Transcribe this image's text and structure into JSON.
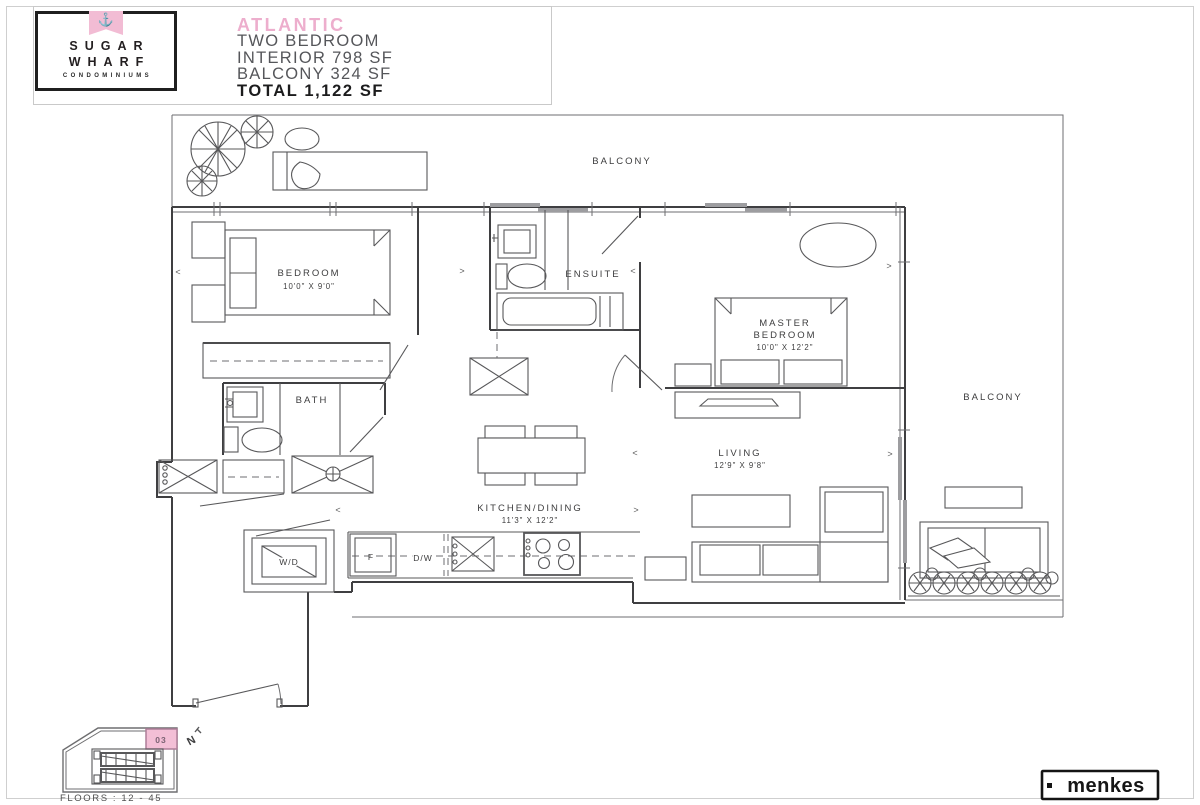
{
  "header": {
    "logo": {
      "anchor": "⚓",
      "word1": "SUGAR",
      "word2": "WHARF",
      "word3": "CONDOMINIUMS"
    },
    "title": {
      "name": "ATLANTIC",
      "line1": "TWO BEDROOM",
      "line2": "INTERIOR 798 SF",
      "line3": "BALCONY 324 SF",
      "total": "TOTAL 1,122 SF"
    }
  },
  "plan": {
    "balcony_top": "BALCONY",
    "balcony_right": "BALCONY",
    "bedroom": {
      "name": "BEDROOM",
      "dims": "10'0\" X 9'0\""
    },
    "ensuite": "ENSUITE",
    "master": {
      "l1": "MASTER",
      "l2": "BEDROOM",
      "dims": "10'0\" X 12'2\""
    },
    "bath": "BATH",
    "kitchen": {
      "name": "KITCHEN/DINING",
      "dims": "11'3\" X 12'2\""
    },
    "living": {
      "name": "LIVING",
      "dims": "12'9\" X 9'8\""
    },
    "washer_dryer": "W/D",
    "fridge": "F",
    "dishwasher": "D/W"
  },
  "markers": {
    "lt": "<",
    "gt": ">"
  },
  "keyplan": {
    "unit": "03",
    "floors": "FLOORS : 12 - 45",
    "north": "N"
  },
  "footer": {
    "brand": "menkes"
  },
  "colors": {
    "accent_pink": "#edaecd",
    "unit_fill": "#f3bfd6",
    "unit_border": "#ae7f99",
    "line": "#3f3f41"
  }
}
